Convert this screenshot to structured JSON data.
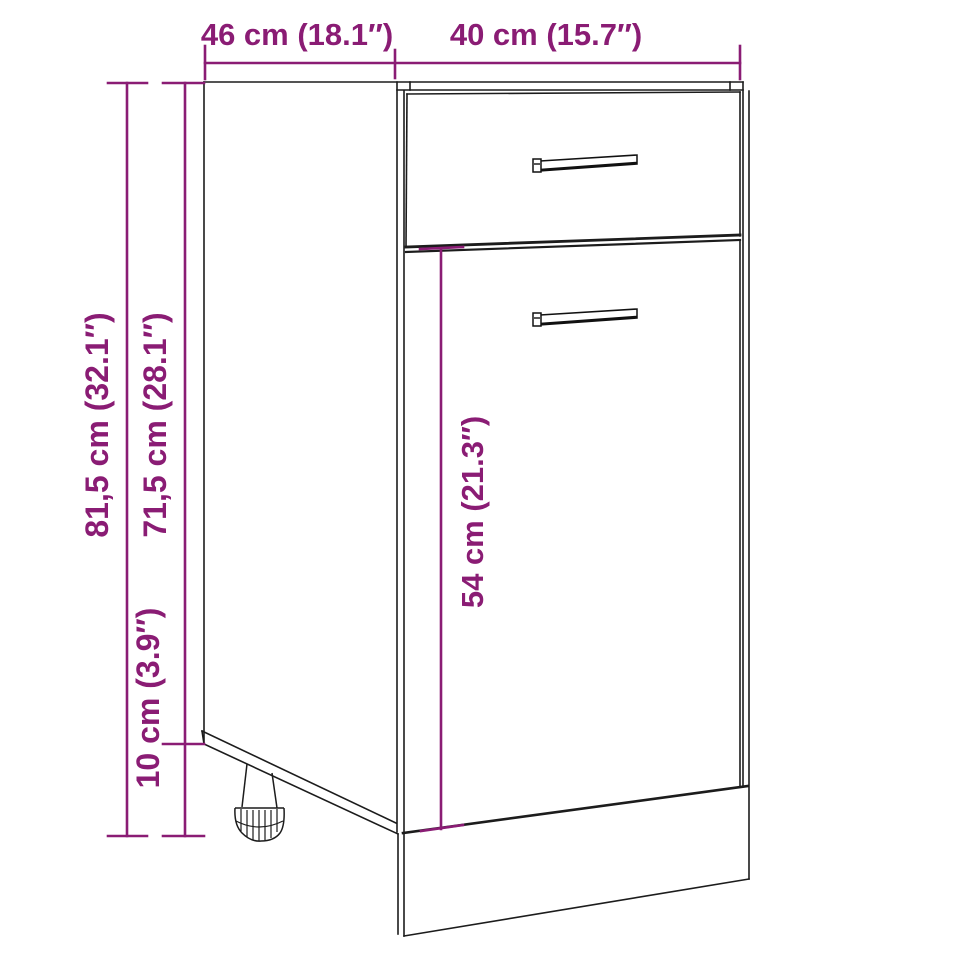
{
  "diagram": {
    "kind": "furniture-dimension-drawing",
    "subject": "kitchen base cabinet with one drawer, one door and adjustable foot",
    "colors": {
      "dimension_accent": "#8a1c74",
      "outline": "#1c1c1c",
      "background": "#ffffff"
    },
    "dims": {
      "depth_top": {
        "text": "46 cm (18.1″)",
        "value_cm": "46",
        "value_in": "18.1"
      },
      "width_top": {
        "text": "40 cm (15.7″)",
        "value_cm": "40",
        "value_in": "15.7"
      },
      "height_total": {
        "text": "81,5 cm (32.1″)",
        "value_cm": "81,5",
        "value_in": "32.1"
      },
      "height_carcass": {
        "text": "71,5 cm (28.1″)",
        "value_cm": "71,5",
        "value_in": "28.1"
      },
      "height_legs": {
        "text": "10 cm (3.9″)",
        "value_cm": "10",
        "value_in": "3.9"
      },
      "height_door": {
        "text": "54 cm (21.3″)",
        "value_cm": "54",
        "value_in": "21.3"
      }
    }
  }
}
